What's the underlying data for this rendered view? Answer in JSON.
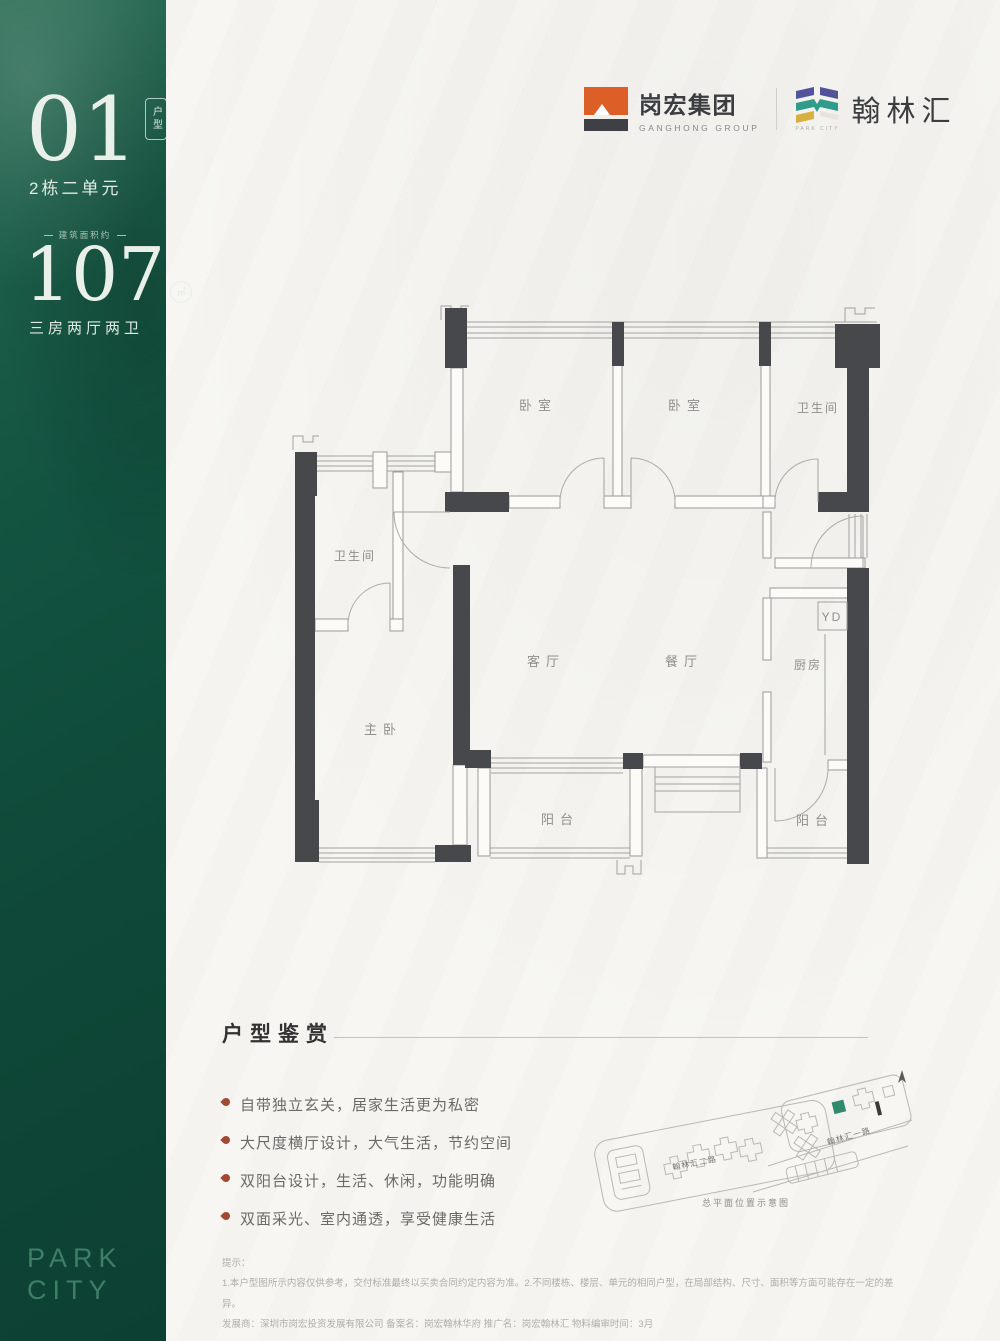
{
  "sidebar": {
    "unit_number": "01",
    "unit_badge": "户型",
    "building": "2栋二单元",
    "area_label": "建筑面积约",
    "area_value": "107",
    "area_unit": "㎡",
    "layout": "三房两厅两卫",
    "brand_line1": "PARK",
    "brand_line2": "CITY"
  },
  "header": {
    "ganghong": {
      "name_cn": "岗宏集团",
      "name_en": "GANGHONG GROUP"
    },
    "hanlinhui": {
      "name_cn": "翰林汇",
      "name_en": "PARK CITY"
    }
  },
  "floorplan": {
    "rooms": {
      "bedroom1": "卧室",
      "bedroom2": "卧室",
      "bath_top": "卫生间",
      "bath_left": "卫生间",
      "master": "主卧",
      "living": "客厅",
      "dining": "餐厅",
      "kitchen": "厨房",
      "duct": "YD",
      "balcony_left": "阳台",
      "balcony_right": "阳台"
    }
  },
  "features": {
    "heading": "户型鉴赏",
    "items": [
      "自带独立玄关，居家生活更为私密",
      "大尺度横厅设计，大气生活，节约空间",
      "双阳台设计，生活、休闲，功能明确",
      "双面采光、室内通透，享受健康生活"
    ]
  },
  "siteplan": {
    "road1": "翰林汇二路",
    "road2": "翰林汇一路",
    "caption": "总平面位置示意图"
  },
  "disclaimer": {
    "title": "提示：",
    "line1": "1.本户型图所示内容仅供参考，交付标准最终以买卖合同约定内容为准。2.不同楼栋、楼层、单元的相同户型，在局部结构、尺寸、面积等方面可能存在一定的差异。",
    "line2": "发展商：深圳市岗宏投资发展有限公司  备案名：岗宏翰林华府  推广名：岗宏翰林汇  物料编审时间：3月"
  },
  "colors": {
    "sidebar_green": "#11523F",
    "wall_dark": "#47484B",
    "ganghong_orange": "#DC5F28",
    "hanlin_purple": "#53539B",
    "hanlin_teal": "#2F9C8C",
    "hanlin_yellow": "#D6B13F",
    "bullet_red": "#A04A34",
    "highlight_building_green": "#2F8A6E"
  }
}
